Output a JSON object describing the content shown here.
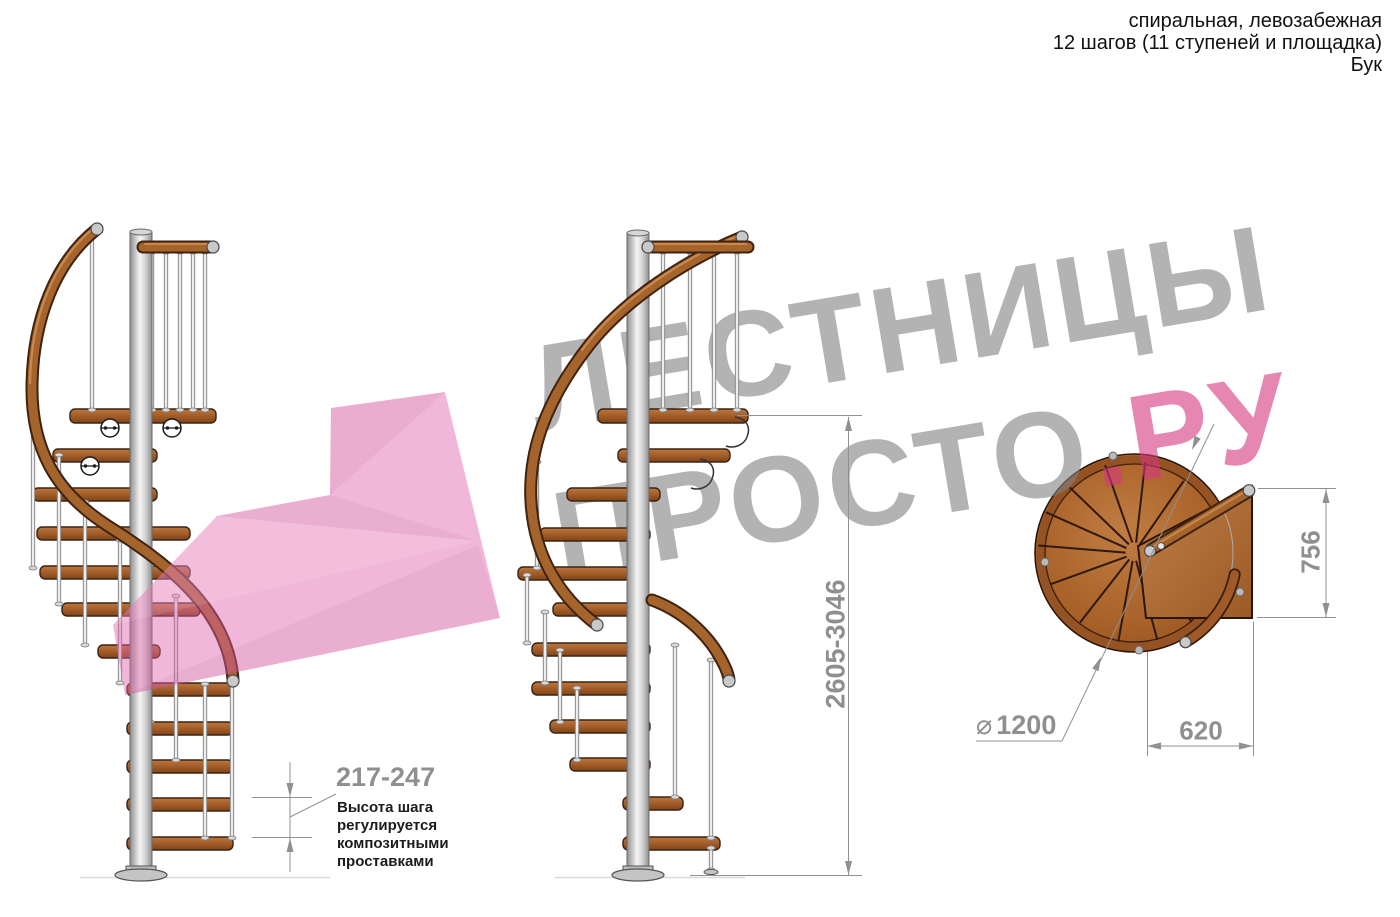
{
  "header": {
    "lines": [
      "спиральная, левозабежная",
      "12 шагов (11 ступеней и площадка)",
      "Бук"
    ]
  },
  "watermark": {
    "line1": "ЛЕСТНИЦЫ",
    "line2_gray": "ПРОСТО",
    "line2_pink": ".РУ",
    "gray_color": "#8c8c8c",
    "pink_color": "#d63780"
  },
  "dims": {
    "total_height": "2605-3046",
    "platform_depth": "756",
    "platform_width": "620",
    "diameter_symbol": "⌀",
    "diameter_value": "1200",
    "step_height": "217-247"
  },
  "note": {
    "lines": [
      "Высота шага",
      "регулируется",
      "композитными",
      "проставками"
    ]
  },
  "colors": {
    "wood": "#a5642c",
    "wood_dark": "#3f2310",
    "metal_light": "#f2f2f2",
    "metal_mid": "#c9c9c9",
    "dimension_gray": "#8f8f8f",
    "arrow_pink": "#e060a8"
  }
}
